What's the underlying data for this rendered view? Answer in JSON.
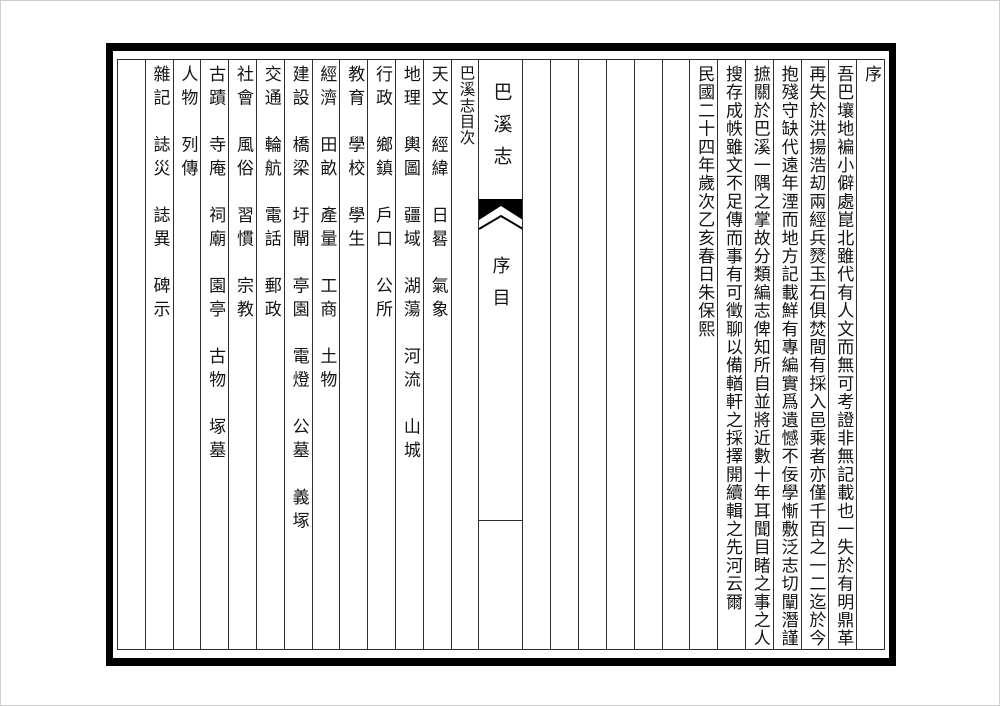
{
  "book": {
    "banxin": {
      "title": "巴溪志",
      "section": "序目"
    },
    "preface": {
      "heading": "序",
      "lines": [
        "吾巴壤地褊小僻處崑北雖代有人文而無可考證非無記載也一失於有明鼎革",
        "再失於洪揚浩刧兩經兵燹玉石俱焚間有採入邑乘者亦僅千百之一二迄於今",
        "抱殘守缺代遠年湮而地方記載鮮有專編實爲遺憾不佞學慚敷泛志切闡潛謹",
        "摭關於巴溪一隅之掌故分類編志俾知所自並將近數十年耳聞目睹之事之人",
        "搜存成帙雖文不足傳而事有可徵聊以備輶軒之採擇開續輯之先河云爾"
      ],
      "signature": "民國二十四年歲次乙亥春日朱保熙"
    },
    "toc": {
      "title": "巴溪志目次",
      "entries": [
        {
          "category": "天文",
          "items": [
            "經緯",
            "日晷",
            "氣象"
          ]
        },
        {
          "category": "地理",
          "items": [
            "輿圖",
            "疆域",
            "湖蕩",
            "河流",
            "山城"
          ]
        },
        {
          "category": "行政",
          "items": [
            "鄉鎮",
            "戶口",
            "公所"
          ]
        },
        {
          "category": "教育",
          "items": [
            "學校",
            "學生"
          ]
        },
        {
          "category": "經濟",
          "items": [
            "田畝",
            "產量",
            "工商",
            "土物"
          ]
        },
        {
          "category": "建設",
          "items": [
            "橋梁",
            "圩閘",
            "亭園",
            "電燈",
            "公墓",
            "義塚"
          ]
        },
        {
          "category": "交通",
          "items": [
            "輪航",
            "電話",
            "郵政"
          ]
        },
        {
          "category": "社會",
          "items": [
            "風俗",
            "習慣",
            "宗教"
          ]
        },
        {
          "category": "古蹟",
          "items": [
            "寺庵",
            "祠廟",
            "園亭",
            "古物",
            "塚墓"
          ]
        },
        {
          "category": "人物",
          "items": [
            "列傳"
          ]
        },
        {
          "category": "雜記",
          "items": [
            "誌災",
            "誌異",
            "碑示"
          ]
        }
      ]
    }
  },
  "layout": {
    "blank_columns_between_preface_and_contents": 6,
    "blank_columns_at_left_edge": 1,
    "frame_color": "#000000",
    "rule_color": "#2f2f2f",
    "ink_color": "#141414",
    "paper_color": "#ffffff"
  }
}
